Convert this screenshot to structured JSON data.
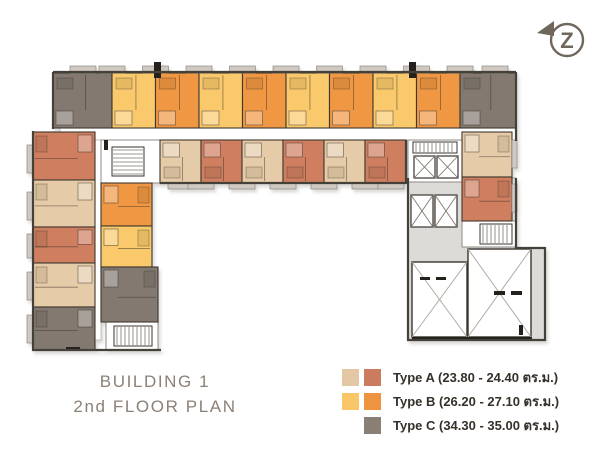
{
  "title": {
    "line1": "BUILDING 1",
    "line2": "2nd FLOOR PLAN"
  },
  "north_badge": {
    "letter": "Z"
  },
  "legend": {
    "items": [
      {
        "label": "Type A (23.80 - 24.40 ตร.ม.)",
        "swatches": [
          "#e4c7a4",
          "#cb7c5e"
        ]
      },
      {
        "label": "Type B (26.20 - 27.10 ตร.ม.)",
        "swatches": [
          "#f9c768",
          "#ee9440"
        ]
      },
      {
        "label": "Type C (34.30 - 35.00 ตร.ม.)",
        "swatches": [
          "#8a7f75"
        ]
      }
    ]
  },
  "colors": {
    "type_a_light": "#e6cba8",
    "type_a_dark": "#cf7f60",
    "type_b_light": "#f9c96b",
    "type_b_dark": "#ef9743",
    "type_c": "#837970",
    "slab": "#dddbd7",
    "wall": "#44403a",
    "title_text": "#8b8177",
    "legend_text": "#363029",
    "badge": "#6f675c"
  },
  "floorplan": {
    "units": [
      {
        "t": "C",
        "o": "s",
        "x": 53,
        "y": 73,
        "w": 59,
        "h": 55
      },
      {
        "t": "B1",
        "o": "s",
        "x": 112,
        "y": 73,
        "w": 43.5,
        "h": 55
      },
      {
        "t": "B2",
        "o": "s",
        "x": 155.5,
        "y": 73,
        "w": 43.5,
        "h": 55
      },
      {
        "t": "B1",
        "o": "s",
        "x": 199,
        "y": 73,
        "w": 43.5,
        "h": 55
      },
      {
        "t": "B2",
        "o": "s",
        "x": 242.5,
        "y": 73,
        "w": 43.5,
        "h": 55
      },
      {
        "t": "B1",
        "o": "s",
        "x": 286,
        "y": 73,
        "w": 43.5,
        "h": 55
      },
      {
        "t": "B2",
        "o": "s",
        "x": 329.5,
        "y": 73,
        "w": 43.5,
        "h": 55
      },
      {
        "t": "B1",
        "o": "s",
        "x": 373,
        "y": 73,
        "w": 43.5,
        "h": 55
      },
      {
        "t": "B2",
        "o": "s",
        "x": 416.5,
        "y": 73,
        "w": 43.5,
        "h": 55
      },
      {
        "t": "C",
        "o": "s",
        "x": 460,
        "y": 73,
        "w": 56,
        "h": 55
      },
      {
        "t": "A1",
        "o": "n",
        "x": 160,
        "y": 140,
        "w": 41,
        "h": 43
      },
      {
        "t": "A2",
        "o": "n",
        "x": 201,
        "y": 140,
        "w": 41,
        "h": 43
      },
      {
        "t": "A1",
        "o": "n",
        "x": 242,
        "y": 140,
        "w": 41,
        "h": 43
      },
      {
        "t": "A2",
        "o": "n",
        "x": 283,
        "y": 140,
        "w": 41,
        "h": 43
      },
      {
        "t": "A1",
        "o": "n",
        "x": 324,
        "y": 140,
        "w": 41,
        "h": 43
      },
      {
        "t": "A2",
        "o": "n",
        "x": 365,
        "y": 140,
        "w": 41,
        "h": 43
      },
      {
        "t": "A2",
        "o": "e",
        "x": 33,
        "y": 132,
        "w": 62,
        "h": 48
      },
      {
        "t": "A1",
        "o": "e",
        "x": 33,
        "y": 180,
        "w": 62,
        "h": 47
      },
      {
        "t": "A2",
        "o": "e",
        "x": 33,
        "y": 227,
        "w": 62,
        "h": 36
      },
      {
        "t": "A1",
        "o": "e",
        "x": 33,
        "y": 263,
        "w": 62,
        "h": 44
      },
      {
        "t": "C",
        "o": "e",
        "x": 33,
        "y": 307,
        "w": 62,
        "h": 43
      },
      {
        "t": "B2",
        "o": "w",
        "x": 101,
        "y": 183,
        "w": 51,
        "h": 43
      },
      {
        "t": "B1",
        "o": "w",
        "x": 101,
        "y": 226,
        "w": 51,
        "h": 41
      },
      {
        "t": "C",
        "o": "w",
        "x": 101,
        "y": 267,
        "w": 57,
        "h": 55
      },
      {
        "t": "A1",
        "o": "w",
        "x": 462,
        "y": 132,
        "w": 50,
        "h": 45
      },
      {
        "t": "A2",
        "o": "w",
        "x": 462,
        "y": 177,
        "w": 50,
        "h": 44
      }
    ],
    "corridors": [
      [
        60,
        128,
        456,
        12
      ],
      [
        95,
        140,
        6,
        200
      ]
    ],
    "slabs": [
      [
        408,
        178,
        108,
        162
      ],
      [
        516,
        248,
        29,
        92
      ]
    ],
    "cores": [
      [
        101,
        140,
        59,
        43
      ],
      [
        106,
        322,
        52,
        28
      ],
      [
        408,
        140,
        54,
        42
      ],
      [
        462,
        221,
        54,
        26
      ]
    ],
    "stairs": [
      [
        112,
        147,
        32,
        29,
        "h"
      ],
      [
        114,
        326,
        38,
        20,
        "v"
      ],
      [
        413,
        142,
        44,
        11,
        "v"
      ],
      [
        480,
        224,
        32,
        20,
        "v"
      ]
    ],
    "elevators": [
      [
        414,
        156,
        21,
        22
      ],
      [
        437,
        156,
        21,
        22
      ],
      [
        411,
        195,
        22,
        32
      ],
      [
        435,
        195,
        22,
        32
      ]
    ],
    "xrooms": [
      [
        412,
        262,
        55,
        75
      ],
      [
        468,
        249,
        63,
        88
      ]
    ],
    "tabs": [
      [
        70,
        66,
        26,
        7
      ],
      [
        99,
        66,
        26,
        7
      ],
      [
        142.5,
        66,
        26,
        7
      ],
      [
        186,
        66,
        26,
        7
      ],
      [
        229.5,
        66,
        26,
        7
      ],
      [
        273,
        66,
        26,
        7
      ],
      [
        316.5,
        66,
        26,
        7
      ],
      [
        360,
        66,
        26,
        7
      ],
      [
        403.5,
        66,
        26,
        7
      ],
      [
        447,
        66,
        26,
        7
      ],
      [
        482,
        66,
        26,
        7
      ],
      [
        168,
        183,
        26,
        6
      ],
      [
        188,
        183,
        26,
        6
      ],
      [
        229,
        183,
        26,
        6
      ],
      [
        270,
        183,
        26,
        6
      ],
      [
        311,
        183,
        26,
        6
      ],
      [
        352,
        183,
        26,
        6
      ],
      [
        378,
        183,
        26,
        6
      ],
      [
        27,
        145,
        6,
        28
      ],
      [
        27,
        192,
        6,
        28
      ],
      [
        27,
        234,
        6,
        24
      ],
      [
        27,
        272,
        6,
        28
      ],
      [
        27,
        315,
        6,
        28
      ],
      [
        512,
        140,
        5,
        28
      ],
      [
        512,
        184,
        5,
        28
      ]
    ],
    "marks": [
      [
        154,
        62,
        7,
        16
      ],
      [
        409,
        62,
        7,
        16
      ],
      [
        412,
        337,
        120,
        4
      ],
      [
        420,
        277,
        10,
        3
      ],
      [
        436,
        277,
        10,
        3
      ],
      [
        494,
        291,
        11,
        4
      ],
      [
        511,
        291,
        11,
        4
      ],
      [
        519,
        325,
        4,
        10
      ],
      [
        66,
        347,
        14,
        4
      ],
      [
        104,
        140,
        4,
        10
      ]
    ],
    "edges": [
      [
        53,
        72,
        516,
        72
      ],
      [
        53,
        72,
        53,
        129
      ],
      [
        516,
        72,
        516,
        141
      ],
      [
        33,
        131,
        33,
        351
      ],
      [
        32,
        350,
        161,
        350
      ],
      [
        406,
        140,
        406,
        184
      ],
      [
        160,
        183,
        406,
        183
      ],
      [
        408,
        178,
        408,
        341
      ],
      [
        407,
        340,
        546,
        340
      ],
      [
        545,
        247,
        545,
        341
      ],
      [
        516,
        178,
        516,
        249
      ],
      [
        516,
        248,
        545,
        248
      ]
    ]
  }
}
